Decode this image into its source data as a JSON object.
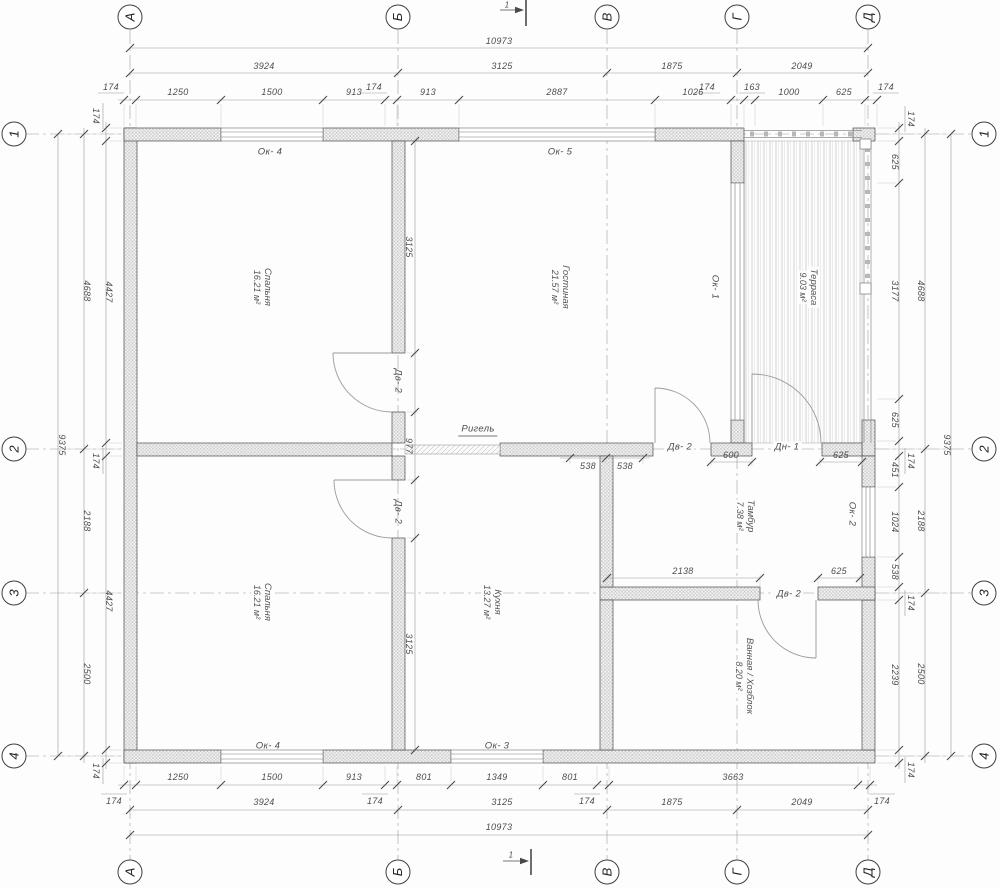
{
  "colors": {
    "ink": "#3f3f3f",
    "line": "#8a8a8a",
    "wall_fill": "#f2f2f2"
  },
  "axes": {
    "cols": [
      "А",
      "Б",
      "В",
      "Г",
      "Д"
    ],
    "rows": [
      "1",
      "2",
      "3",
      "4"
    ]
  },
  "section_marks": {
    "top": "1",
    "bottom": "1"
  },
  "rooms": [
    {
      "name": "Спальня",
      "area": "16.21 м²"
    },
    {
      "name": "Гостиная",
      "area": "21.57 м²"
    },
    {
      "name": "Терраса",
      "area": "9.03 м²"
    },
    {
      "name": "Спальня",
      "area": "16.21 м²"
    },
    {
      "name": "Кухня",
      "area": "13.27 м²"
    },
    {
      "name": "Тамбур",
      "area": "7.38 м²"
    },
    {
      "name": "Ванная / Хозблок",
      "area": "8.20 м²"
    }
  ],
  "openings": {
    "ok4_top": "Ок- 4",
    "ok5": "Ок- 5",
    "ok1": "Ок- 1",
    "ok2": "Ок- 2",
    "ok4_bottom": "Ок- 4",
    "ok3": "Ок- 3",
    "dv2_b_upper": "Дв- 2",
    "dv2_b_lower": "Дв- 2",
    "dv2_tambour": "Дв- 2",
    "dn1": "Дн- 1",
    "dv2_bath": "Дв- 2"
  },
  "beam_label": "Ригель",
  "dims": {
    "top_overall": "10973",
    "top_mid": [
      "3924",
      "3125",
      "1875",
      "2049"
    ],
    "top_detail": [
      "1250",
      "1500",
      "913",
      "913",
      "2887",
      "1026",
      "1000",
      "625"
    ],
    "top_leaders": [
      "174",
      "174",
      "174",
      "163",
      "174"
    ],
    "bottom_overall": "10973",
    "bottom_mid": [
      "3924",
      "3125",
      "1875",
      "2049"
    ],
    "bottom_detail": [
      "1250",
      "1500",
      "913",
      "801",
      "1349",
      "801",
      "3663"
    ],
    "bottom_leaders": [
      "174",
      "174",
      "174",
      "174"
    ],
    "left_outer": "9375",
    "left_mid": [
      "4688",
      "2188",
      "2500"
    ],
    "left_inner": [
      "4427",
      "4427"
    ],
    "left_wall": [
      "174",
      "174",
      "174"
    ],
    "right_outer": "9375",
    "right_mid": [
      "4688",
      "2188",
      "2500"
    ],
    "right_inner": [
      "625",
      "3177",
      "625",
      "451",
      "1024",
      "538",
      "2239"
    ],
    "right_wall": [
      "174",
      "174",
      "174",
      "174"
    ],
    "interior": {
      "v_top": "3125",
      "v_mid": "977",
      "v_bottom": "3125",
      "h538_left": "538",
      "h538_right": "538",
      "h600": "600",
      "h625_top": "625",
      "h2138": "2138",
      "h625_bottom": "625"
    }
  }
}
